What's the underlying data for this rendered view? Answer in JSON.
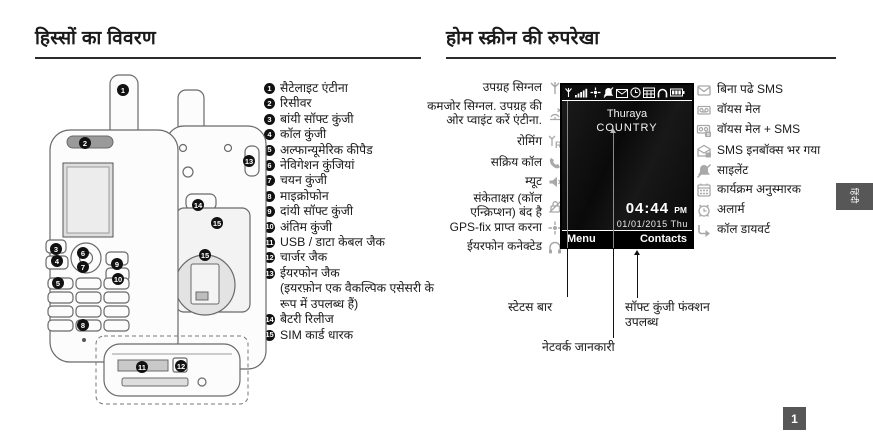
{
  "doc": {
    "left_title": "हिस्सों का विवरण",
    "right_title": "होम स्क्रीन की रुपरेखा",
    "side_tab": "हिंदी",
    "page_number": "1"
  },
  "parts": {
    "items": [
      {
        "num": "1",
        "label": "सैटेलाइट एंटीना"
      },
      {
        "num": "2",
        "label": "रिसीवर"
      },
      {
        "num": "3",
        "label": "बांयी सॉफ्ट कुंजी"
      },
      {
        "num": "4",
        "label": "कॉल कुंजी"
      },
      {
        "num": "5",
        "label": "अल्फान्यूमेरिक कीपैड"
      },
      {
        "num": "6",
        "label": "नेविगेशन कुंजियां"
      },
      {
        "num": "7",
        "label": "चयन कुंजी"
      },
      {
        "num": "8",
        "label": "माइक्रोफोन"
      },
      {
        "num": "9",
        "label": "दांयी सॉफ्ट कुंजी"
      },
      {
        "num": "10",
        "label": "अंतिम कुंजी"
      },
      {
        "num": "11",
        "label": "USB / डाटा केबल जैक"
      },
      {
        "num": "12",
        "label": "चार्जर जैक"
      },
      {
        "num": "13",
        "label": "ईयरफोन जैक",
        "note": "(इयरफ़ोन एक वैकल्पिक एसेसरी के रूप में उपलब्ध हैं)"
      },
      {
        "num": "14",
        "label": "बैटरी रिलीज"
      },
      {
        "num": "15",
        "label": "SIM कार्ड धारक"
      }
    ]
  },
  "home": {
    "left_labels": [
      {
        "label": "उपग्रह सिग्नल",
        "icon": "satellite-signal-icon"
      },
      {
        "label": "कमजोर सिग्नल. उपग्रह की ओर प्वाइंट करें एंटीना.",
        "icon": "weak-signal-icon"
      },
      {
        "label": "रोमिंग",
        "icon": "roaming-icon"
      },
      {
        "label": "सक्रिय कॉल",
        "icon": "active-call-icon"
      },
      {
        "label": "म्यूट",
        "icon": "mute-icon"
      },
      {
        "label": "संकेताक्षर (कॉल एन्क्रिप्शन) बंद है",
        "icon": "encryption-off-icon"
      },
      {
        "label": "GPS-fix प्राप्त करना",
        "icon": "gps-fix-icon"
      },
      {
        "label": "ईयरफोन कनेक्टेड",
        "icon": "earphone-icon"
      }
    ],
    "right_labels": [
      {
        "label": "बिना पढे SMS",
        "icon": "unread-sms-icon"
      },
      {
        "label": "वॉयस मेल",
        "icon": "voice-mail-icon"
      },
      {
        "label": "वॉयस मेल + SMS",
        "icon": "voice-mail-sms-icon"
      },
      {
        "label": "SMS इनबॉक्स भर गया",
        "icon": "sms-inbox-full-icon"
      },
      {
        "label": "साइलेंट",
        "icon": "silent-icon"
      },
      {
        "label": "कार्यक्रम अनुस्मारक",
        "icon": "schedule-reminder-icon"
      },
      {
        "label": "अलार्म",
        "icon": "alarm-icon"
      },
      {
        "label": "कॉल डायवर्ट",
        "icon": "call-divert-icon"
      }
    ],
    "screen": {
      "network_line1": "Thuraya",
      "network_line2": "COUNTRY",
      "time": "04:44",
      "time_suffix": "PM",
      "date": "01/01/2015 Thu",
      "softkey_left": "Menu",
      "softkey_right": "Contacts",
      "status_icons": [
        "satellite",
        "signal-strength",
        "gps",
        "silent",
        "sms-inbox",
        "clock",
        "calendar",
        "headset",
        "battery"
      ]
    },
    "callout_labels": {
      "status_bar": "स्टेटस बार",
      "softkey_functions": "सॉफ्ट कुंजी फंक्शन उपलब्ध",
      "network_info": "नेटवर्क जानकारी"
    }
  },
  "colors": {
    "paper": "#ffffff",
    "text": "#1a1a1a",
    "screen_bg": "#0d0d0d",
    "screen_text": "#ffffff",
    "icon_gray": "#a8a8a8",
    "tab_bg": "#575757"
  }
}
